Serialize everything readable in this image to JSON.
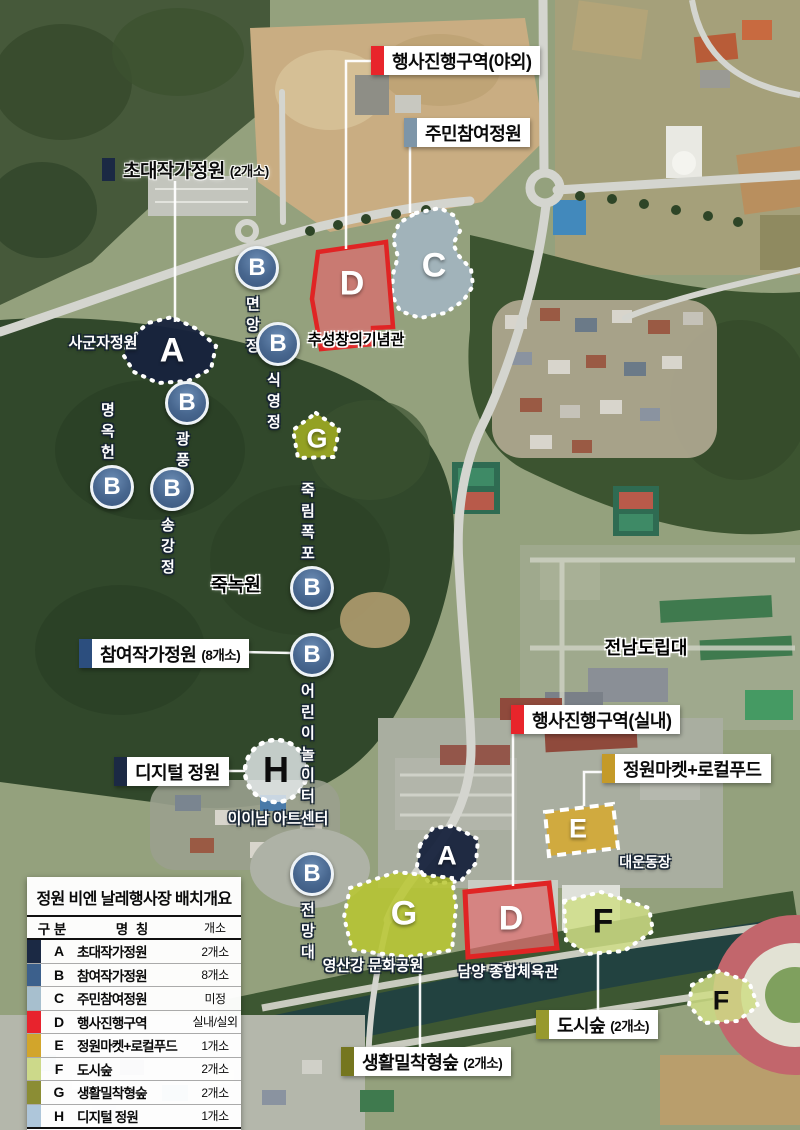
{
  "callouts": {
    "outdoor_event": {
      "text": "행사진행구역(야외)",
      "bar": "#e8252b"
    },
    "resident_garden": {
      "text": "주민참여정원",
      "bar": "#7d95a8"
    },
    "invited_garden": {
      "text": "초대작가정원",
      "suffix": "(2개소)",
      "bar": "#1b2944"
    },
    "participating_garden": {
      "text": "참여작가정원",
      "suffix": "(8개소)",
      "bar": "#2c4e7e"
    },
    "digital_garden": {
      "text": "디지털 정원",
      "bar": "#1b2944"
    },
    "indoor_event": {
      "text": "행사진행구역(실내)",
      "bar": "#e8252b"
    },
    "garden_market": {
      "text": "정원마켓+로컬푸드",
      "bar": "#c49a28"
    },
    "city_forest": {
      "text": "도시숲",
      "suffix": "(2개소)",
      "bar": "#97992e"
    },
    "life_forest": {
      "text": "생활밀착형숲",
      "suffix": "(2개소)",
      "bar": "#75761f"
    }
  },
  "markers": [
    {
      "letter": "B",
      "label": "면앙정"
    },
    {
      "letter": "B",
      "label": "식영정"
    },
    {
      "letter": "B",
      "label": "광풍각"
    },
    {
      "letter": "B",
      "label": "명옥헌"
    },
    {
      "letter": "B",
      "label": "송강정"
    },
    {
      "letter": "B",
      "label": "죽림폭포"
    },
    {
      "letter": "B",
      "label": "어린이놀이터"
    },
    {
      "letter": "B",
      "label": "전망대"
    }
  ],
  "areas": {
    "a_top": "A",
    "c_top": "C",
    "d_top": "D",
    "g_top": "G",
    "h": "H",
    "a_bottom": "A",
    "g_bottom": "G",
    "d_bottom": "D",
    "f_mid": "F",
    "e": "E",
    "f_river": "F"
  },
  "places": {
    "sagunja": "사군자정원",
    "chuseong_hall": "추성창의기념관",
    "juknokwon": "죽녹원",
    "jeonnam_college": "전남도립대",
    "artcenter": "이이남 아트센터",
    "main_field": "대운동장",
    "damyang_gym": "담양 종합체육관",
    "yeongsan_park": "영산강 문화공원"
  },
  "legend": {
    "title": "정원 비엔 날레행사장 배치개요",
    "columns": {
      "division": "구 분",
      "name": "명 칭",
      "count": "개소"
    },
    "rows": [
      {
        "key": "A",
        "name": "초대작가정원",
        "count": "2개소",
        "color": "#1b2944"
      },
      {
        "key": "B",
        "name": "참여작가정원",
        "count": "8개소",
        "color": "#3c608c"
      },
      {
        "key": "C",
        "name": "주민참여정원",
        "count": "미정",
        "color": "#a7bfce"
      },
      {
        "key": "D",
        "name": "행사진행구역",
        "count": "실내/실외",
        "color": "#e8232d"
      },
      {
        "key": "E",
        "name": "정원마켓+로컬푸드",
        "count": "1개소",
        "color": "#d2a52b"
      },
      {
        "key": "F",
        "name": "도시숲",
        "count": "2개소",
        "color": "#ccd98a"
      },
      {
        "key": "G",
        "name": "생활밀착형숲",
        "count": "2개소",
        "color": "#8b8d34"
      },
      {
        "key": "H",
        "name": "디지털 정원",
        "count": "1개소",
        "color": "#aec6da"
      }
    ]
  }
}
